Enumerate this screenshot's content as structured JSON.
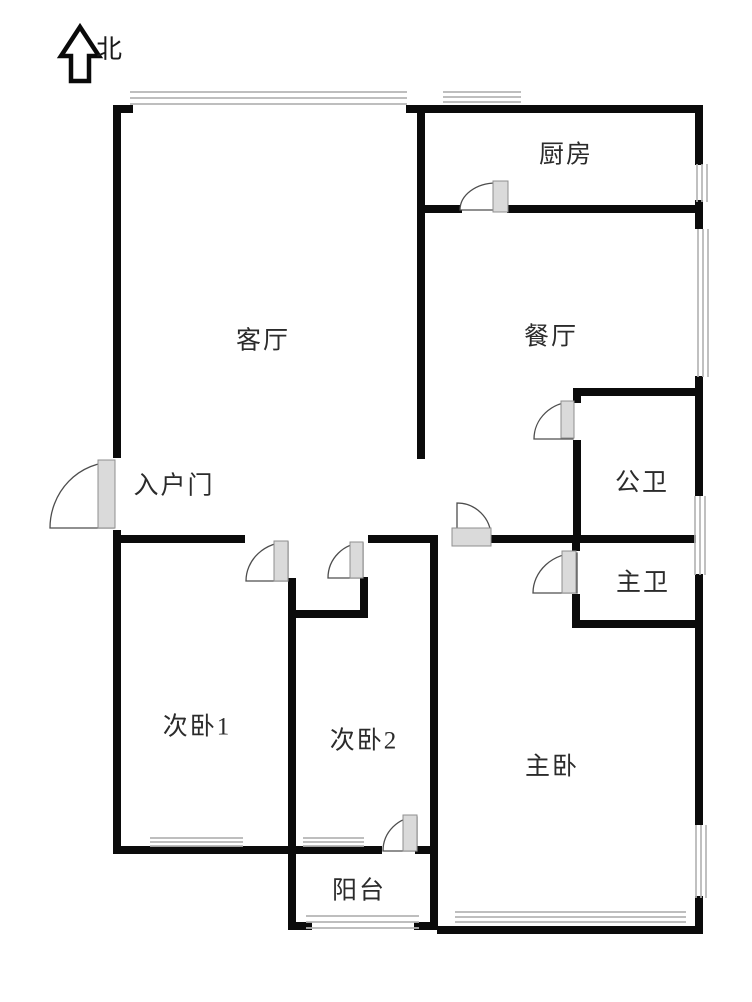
{
  "page": {
    "width": 752,
    "height": 1002,
    "background": "#ffffff"
  },
  "compass": {
    "label": "北",
    "direction": "up"
  },
  "colors": {
    "wall": "#0b0b0b",
    "window_line": "#b5b5b5",
    "door_stroke": "#4d4d4d",
    "door_leaf_fill": "#dadada",
    "door_leaf_stroke": "#8f8f8f",
    "label_text": "#2b2b2b",
    "arrow_stroke": "#0a0a0a"
  },
  "rooms": [
    {
      "id": "living-room",
      "label": "客厅",
      "x": 263,
      "y": 341
    },
    {
      "id": "kitchen",
      "label": "厨房",
      "x": 566,
      "y": 155
    },
    {
      "id": "dining-room",
      "label": "餐厅",
      "x": 551,
      "y": 337
    },
    {
      "id": "guest-bathroom",
      "label": "公卫",
      "x": 642,
      "y": 483
    },
    {
      "id": "entry-door",
      "label": "入户门",
      "x": 174,
      "y": 486
    },
    {
      "id": "master-bathroom",
      "label": "主卫",
      "x": 643,
      "y": 583
    },
    {
      "id": "bedroom-1",
      "label": "次卧1",
      "x": 197,
      "y": 727
    },
    {
      "id": "bedroom-2",
      "label": "次卧2",
      "x": 364,
      "y": 741
    },
    {
      "id": "master-bedroom",
      "label": "主卧",
      "x": 552,
      "y": 767
    },
    {
      "id": "balcony",
      "label": "阳台",
      "x": 359,
      "y": 891
    }
  ],
  "plan": {
    "north_arrow_path": "M80,27 L61,56 L71,56 L71,81 L89,81 L89,56 L99,56 Z",
    "walls": [
      [
        113,
        105,
        8,
        353
      ],
      [
        113,
        530,
        8,
        324
      ],
      [
        113,
        105,
        20,
        8
      ],
      [
        406,
        105,
        18,
        8
      ],
      [
        417,
        105,
        285,
        8
      ],
      [
        695,
        105,
        8,
        60
      ],
      [
        695,
        200,
        8,
        29
      ],
      [
        695,
        376,
        8,
        120
      ],
      [
        695,
        574,
        8,
        251
      ],
      [
        695,
        896,
        8,
        38
      ],
      [
        437,
        926,
        265,
        8
      ],
      [
        288,
        922,
        24,
        8
      ],
      [
        414,
        922,
        24,
        8
      ],
      [
        417,
        205,
        45,
        8
      ],
      [
        507,
        205,
        195,
        8
      ],
      [
        417,
        112,
        8,
        347
      ],
      [
        573,
        388,
        129,
        8
      ],
      [
        573,
        394,
        8,
        9
      ],
      [
        573,
        440,
        8,
        101
      ],
      [
        115,
        535,
        130,
        8
      ],
      [
        368,
        535,
        70,
        8
      ],
      [
        490,
        535,
        206,
        8
      ],
      [
        288,
        610,
        80,
        8
      ],
      [
        360,
        577,
        8,
        41
      ],
      [
        288,
        578,
        8,
        351
      ],
      [
        115,
        846,
        267,
        8
      ],
      [
        415,
        846,
        23,
        8
      ],
      [
        430,
        537,
        8,
        392
      ],
      [
        572,
        537,
        8,
        14
      ],
      [
        572,
        594,
        8,
        33
      ],
      [
        572,
        620,
        130,
        8
      ]
    ],
    "windows": [
      {
        "dir": "h",
        "x": 130,
        "y": 92,
        "len": 277,
        "gap": 6
      },
      {
        "dir": "h",
        "x": 443,
        "y": 92,
        "len": 78,
        "gap": 5
      },
      {
        "dir": "v",
        "x": 697,
        "y": 164,
        "len": 38,
        "gap": 5
      },
      {
        "dir": "v",
        "x": 698,
        "y": 229,
        "len": 148,
        "gap": 5
      },
      {
        "dir": "v",
        "x": 695,
        "y": 496,
        "len": 79,
        "gap": 5
      },
      {
        "dir": "v",
        "x": 696,
        "y": 825,
        "len": 73,
        "gap": 5
      },
      {
        "dir": "h",
        "x": 150,
        "y": 838,
        "len": 93,
        "gap": 4
      },
      {
        "dir": "h",
        "x": 303,
        "y": 838,
        "len": 61,
        "gap": 4
      },
      {
        "dir": "h",
        "x": 455,
        "y": 912,
        "len": 231,
        "gap": 5
      },
      {
        "dir": "h",
        "x": 306,
        "y": 916,
        "len": 113,
        "gap": 6
      }
    ],
    "doors": [
      {
        "name": "entry-door",
        "arc": "M114,528 L50,528 A64,66 0 0 1 114,462 Z",
        "leaf": [
          98,
          460,
          17,
          68
        ]
      },
      {
        "name": "kitchen-door",
        "arc": "M496,210 L460,210 A36,27 0 0 1 496,183 Z",
        "leaf": [
          493,
          181,
          15,
          31
        ]
      },
      {
        "name": "guest-bathroom-door",
        "arc": "M573,439 L534,439 A39,37 0 0 1 573,402 Z",
        "leaf": [
          561,
          401,
          13,
          37
        ]
      },
      {
        "name": "master-bedroom-door",
        "arc": "M457,537 L457,503 A34,34 0 0 1 491,537 Z",
        "leaf": [
          452,
          528,
          39,
          18
        ]
      },
      {
        "name": "master-bathroom-door",
        "arc": "M577,593 L533,593 A44,40 0 0 1 577,553 Z",
        "leaf": [
          562,
          551,
          14,
          42
        ]
      },
      {
        "name": "bedroom-1-door",
        "arc": "M288,581 L246,581 A42,39 0 0 1 288,542 Z",
        "leaf": [
          274,
          541,
          14,
          40
        ]
      },
      {
        "name": "hall-closet-door",
        "arc": "M363,578 L328,578 A35,35 0 0 1 363,543 Z",
        "leaf": [
          350,
          542,
          13,
          36
        ]
      },
      {
        "name": "balcony-door",
        "arc": "M417,851 L383,851 A34,34 0 0 1 417,817 Z",
        "leaf": [
          403,
          815,
          14,
          36
        ]
      }
    ]
  }
}
